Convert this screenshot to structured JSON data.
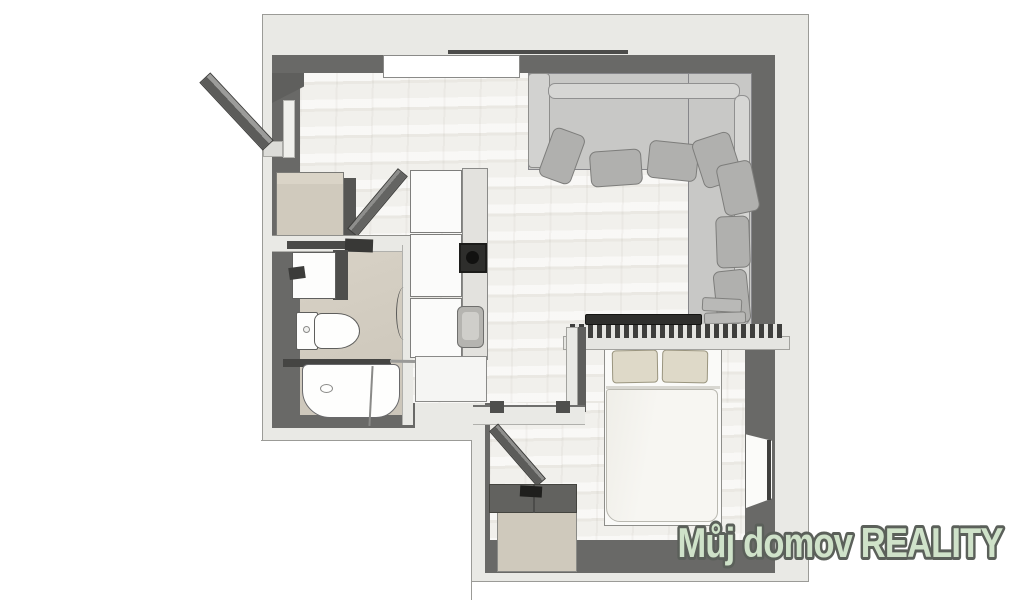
{
  "watermark": {
    "text": "Můj domov REALITY",
    "fill": "#cfe2c9",
    "stroke": "#5b605a"
  },
  "palette": {
    "background": "#ffffff",
    "wall_outer": "#e9e9e5",
    "wall_inner": "#696967",
    "floor_wood": "#f1f0ec",
    "floor_bathroom": "#d2ccc0",
    "sofa_body": "#c8c8c6",
    "sofa_cushion": "#b0b0ae",
    "furniture_beige": "#d0cabd",
    "bed_pillow_beige": "#ded9c8",
    "fixture_white": "#fcfcfb",
    "dark_fixture": "#3a3a38"
  },
  "plan": {
    "type": "studio-apartment-floor-plan",
    "objects": [
      "entrance-door",
      "entry-wardrobe",
      "interior-door",
      "top-window",
      "corner-sofa",
      "sofa-back-cushions",
      "stacked-cushions",
      "kitchen-cabinets",
      "cooktop",
      "kitchen-sink",
      "kitchen-lower-cabinet",
      "bathroom-shelf",
      "washbasin",
      "toilet",
      "bathtub",
      "shower-rail",
      "bathroom-door-arc",
      "tv",
      "slatted-rail",
      "headboard-shelf",
      "partition-wall",
      "double-bed",
      "bed-pillows",
      "duvet",
      "hall-door",
      "storage-box",
      "side-window"
    ]
  }
}
